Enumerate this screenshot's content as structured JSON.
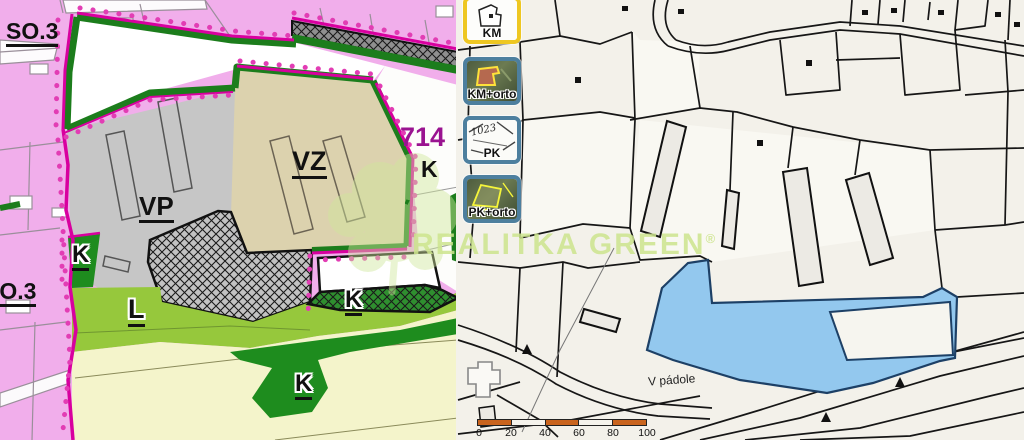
{
  "watermark": {
    "text": "REALITKA GREEN",
    "registered": "®"
  },
  "left_map": {
    "type": "zoning-plan",
    "labels": {
      "so3_top": "SO.3",
      "so3_bottom": "SO.3",
      "vp": "VP",
      "vz": "VZ",
      "parcel_714": "714",
      "k_right": "K",
      "k_small_parcel": "K",
      "l_zone": "L",
      "k_hatch_zone": "K",
      "k_band_zone": "K"
    },
    "colors": {
      "pink_zone": "#f1aeeb",
      "white_zone": "#ffffff",
      "gray_vp_zone": "#c6c6c6",
      "tan_vz_zone": "#dcd2ae",
      "lime_l_zone": "#96c83c",
      "dark_green_k_zone": "#1e8c1e",
      "pale_yellow_zone": "#f4f4cb",
      "border_green": "#1c7d1c",
      "boundary_magenta": "#d8009f",
      "label_714": "#9a1390"
    }
  },
  "map_switcher": {
    "buttons": [
      {
        "label": "KM",
        "active": true
      },
      {
        "label": "KM+orto",
        "active": false
      },
      {
        "label": "PK",
        "active": false,
        "thumb_text": "1023"
      },
      {
        "label": "PK+orto",
        "active": false
      }
    ]
  },
  "right_map": {
    "type": "cadastral-map",
    "place_label": "V pádole",
    "scale_bar": {
      "ticks": [
        "0",
        "20",
        "40",
        "60",
        "80"
      ],
      "end_label": "100 m"
    },
    "colors": {
      "background": "#f3f1ea",
      "water": "#93c8ee",
      "water_outline": "#1d4066",
      "parcel_line": "#161616",
      "scale_orange": "#c9641e"
    }
  }
}
